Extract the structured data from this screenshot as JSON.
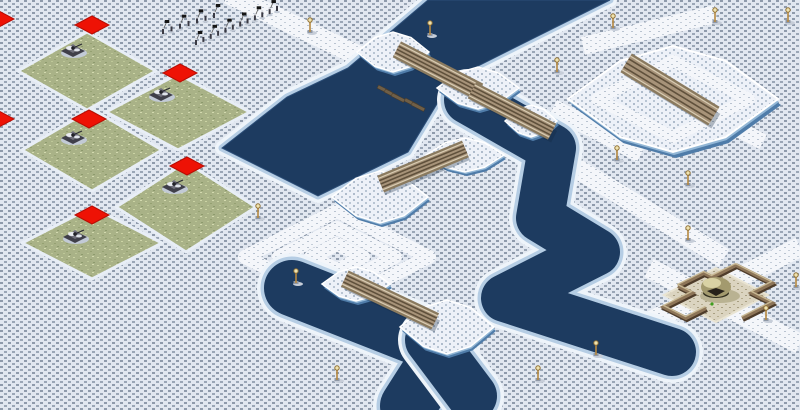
{
  "scene": {
    "kind": "isometric-rts-snow-map",
    "width": 800,
    "height": 410,
    "colors": {
      "snow_base": "#e1e7f0",
      "snow_dot": "#8e9aab",
      "path_base": "#f4f6fa",
      "path_dot": "#b9c3d0",
      "plateau_base": "#edf1f8",
      "plateau_dot": "#aebbcb",
      "grass_base": "#a9b287",
      "grass_light": "#cbd3a4",
      "grass_dark": "#8d9a6d",
      "sand_base": "#dbd4c0",
      "sand_dot": "#a89f82",
      "water": "#1d3b60",
      "water_edge": "#2c4e78",
      "shore_ice": "#b5cde4",
      "shore_fringe": "#eef4fa",
      "cliff_dark": "#4f7ca9",
      "cliff_mid": "#93b7d6",
      "bridge_deck": "#a79379",
      "bridge_rail": "#8a7a5f",
      "bridge_lane": "#60513c",
      "bridge_light": "#d8cbb2",
      "red_tile": "#ee1205",
      "red_tile_edge": "#b80d04",
      "wall": "#8d7558",
      "wall_shadow": "#4e3c2a",
      "wall_top": "#c8b893",
      "lamp_pole": "#b5883f",
      "lamp_head": "#efe3b0",
      "unit_hull": "#3f3f49",
      "unit_top": "#70707c",
      "unit_snow": "#e9ebf1",
      "dome_body": "#a39a6e",
      "dome_hi": "#d9d2a4",
      "dome_dark": "#26211a",
      "green_light": "#3f9e1e"
    },
    "path_strips": [
      {
        "x1": 228,
        "y1": -6,
        "x2": 372,
        "y2": 62,
        "w": 20
      },
      {
        "x1": 583,
        "y1": 46,
        "x2": 716,
        "y2": 14,
        "w": 18
      },
      {
        "x1": 540,
        "y1": 146,
        "x2": 724,
        "y2": 258,
        "w": 20
      },
      {
        "x1": 800,
        "y1": 247,
        "x2": 641,
        "y2": 326,
        "w": 20
      },
      {
        "x1": 649,
        "y1": 268,
        "x2": 800,
        "y2": 344,
        "w": 20
      },
      {
        "x1": 553,
        "y1": 108,
        "x2": 641,
        "y2": 154,
        "w": 18
      },
      {
        "x1": 705,
        "y1": 112,
        "x2": 763,
        "y2": 142,
        "w": 16
      }
    ],
    "path_spiral": {
      "cx": 337,
      "cy": 257,
      "rings": [
        [
          92,
          46
        ],
        [
          58,
          29
        ],
        [
          26,
          13
        ]
      ],
      "w": 14
    },
    "water_polygons": [
      {
        "points": [
          [
            428,
            0
          ],
          [
            610,
            0
          ],
          [
            452,
            79
          ],
          [
            408,
            152
          ],
          [
            318,
            196
          ],
          [
            222,
            148
          ],
          [
            287,
            97
          ],
          [
            348,
            68
          ]
        ]
      }
    ],
    "water_channels": [
      {
        "w": 48,
        "pts": [
          [
            468,
            100
          ],
          [
            552,
            148
          ],
          [
            540,
            218
          ],
          [
            596,
            252
          ],
          [
            505,
            298
          ],
          [
            672,
            352
          ]
        ]
      },
      {
        "w": 56,
        "pts": [
          [
            292,
            288
          ],
          [
            445,
            348
          ],
          [
            408,
            406
          ]
        ]
      },
      {
        "w": 50,
        "pts": [
          [
            430,
            340
          ],
          [
            472,
            396
          ]
        ]
      }
    ],
    "islands": [
      {
        "cx": 393,
        "cy": 52,
        "rx": 36,
        "ry": 20
      },
      {
        "cx": 478,
        "cy": 88,
        "rx": 41,
        "ry": 21
      },
      {
        "cx": 531,
        "cy": 121,
        "rx": 26,
        "ry": 16
      },
      {
        "cx": 465,
        "cy": 155,
        "rx": 39,
        "ry": 17
      },
      {
        "cx": 380,
        "cy": 197,
        "rx": 48,
        "ry": 26
      },
      {
        "cx": 356,
        "cy": 284,
        "rx": 34,
        "ry": 17
      },
      {
        "cx": 447,
        "cy": 327,
        "rx": 47,
        "ry": 27
      }
    ],
    "plateau": {
      "cx": 673,
      "cy": 99,
      "rx": 105,
      "ry": 53,
      "ring_rx": 76,
      "ring_ry": 38
    },
    "bridges": [
      {
        "x1": 404,
        "y1": 53,
        "x2": 472,
        "y2": 88,
        "w": 13
      },
      {
        "x1": 479,
        "y1": 94,
        "x2": 545,
        "y2": 128,
        "w": 13
      },
      {
        "x1": 388,
        "y1": 181,
        "x2": 458,
        "y2": 152,
        "w": 13
      },
      {
        "x1": 352,
        "y1": 282,
        "x2": 428,
        "y2": 318,
        "w": 13
      },
      {
        "x1": 633,
        "y1": 67,
        "x2": 707,
        "y2": 112,
        "w": 17
      }
    ],
    "debris": [
      {
        "x": 384,
        "y": 90
      },
      {
        "x": 391,
        "y": 94
      },
      {
        "x": 398,
        "y": 98
      },
      {
        "x": 411,
        "y": 103
      },
      {
        "x": 418,
        "y": 107
      }
    ],
    "grass_patches": [
      {
        "cx": 87,
        "cy": 71,
        "rx": 69,
        "ry": 39
      },
      {
        "cx": 178,
        "cy": 112,
        "rx": 72,
        "ry": 38
      },
      {
        "cx": 92,
        "cy": 150,
        "rx": 70,
        "ry": 41
      },
      {
        "cx": 186,
        "cy": 207,
        "rx": 70,
        "ry": 45
      },
      {
        "cx": 92,
        "cy": 243,
        "rx": 70,
        "ry": 36
      }
    ],
    "red_tiles": [
      {
        "cx": 92,
        "cy": 25
      },
      {
        "cx": 180,
        "cy": 73
      },
      {
        "cx": 89,
        "cy": 119
      },
      {
        "cx": 187,
        "cy": 166
      },
      {
        "cx": 92,
        "cy": 215
      },
      {
        "cx": -3,
        "cy": 19
      },
      {
        "cx": -3,
        "cy": 119
      }
    ],
    "vehicles": [
      {
        "x": 73,
        "y": 49
      },
      {
        "x": 161,
        "y": 93
      },
      {
        "x": 73,
        "y": 136
      },
      {
        "x": 174,
        "y": 185
      },
      {
        "x": 75,
        "y": 235
      }
    ],
    "infantry_rows": [
      {
        "x1": 163,
        "y1": 34,
        "x2": 214,
        "y2": 18,
        "count": 7
      },
      {
        "x1": 196,
        "y1": 45,
        "x2": 277,
        "y2": 11,
        "count": 12
      }
    ],
    "lamps": [
      [
        310,
        32
      ],
      [
        430,
        35
      ],
      [
        613,
        28
      ],
      [
        715,
        22
      ],
      [
        788,
        22
      ],
      [
        557,
        72
      ],
      [
        617,
        160
      ],
      [
        688,
        185
      ],
      [
        688,
        240
      ],
      [
        258,
        218
      ],
      [
        296,
        283
      ],
      [
        337,
        380
      ],
      [
        538,
        380
      ],
      [
        596,
        355
      ],
      [
        766,
        320
      ],
      [
        796,
        287
      ]
    ],
    "dome": {
      "cx": 716,
      "cy": 289,
      "pad_rx": 52,
      "pad_ry": 27,
      "light": [
        712,
        304
      ],
      "walls": [
        [
          [
            678,
            286
          ],
          [
            704,
            273
          ],
          [
            712,
            277
          ],
          [
            736,
            265
          ]
        ],
        [
          [
            736,
            265
          ],
          [
            772,
            283
          ],
          [
            752,
            293
          ],
          [
            772,
            303
          ],
          [
            742,
            318
          ]
        ],
        [
          [
            678,
            286
          ],
          [
            692,
            293
          ],
          [
            664,
            307
          ],
          [
            686,
            318
          ],
          [
            706,
            308
          ]
        ]
      ]
    }
  }
}
